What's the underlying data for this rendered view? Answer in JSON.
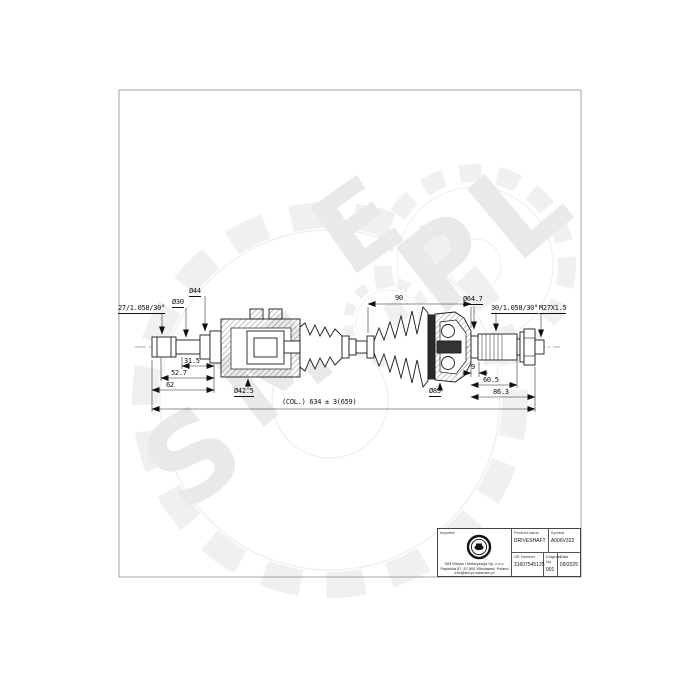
{
  "watermark": {
    "letters": [
      "S",
      "M",
      "E",
      "P",
      "L"
    ]
  },
  "drawing": {
    "labels": {
      "left_spline": "27/1.058/30°",
      "d30": "Ø30",
      "d44": "Ø44",
      "dim_31_5": "31.5",
      "dim_52_7": "52.7",
      "dim_62": "62",
      "d42_5": "Ø42.5",
      "overall": "(COL.) 634 ± 3(659)",
      "dim_90": "90",
      "d85": "Ø85",
      "d64_7": "Ø64.7",
      "right_spline": "30/1.058/30°",
      "thread": "M27X1.5",
      "dim_9": "9",
      "dim_60_5": "60.5",
      "dim_86_3": "86.3"
    }
  },
  "title_block": {
    "importer_label": "Importer",
    "importer_lines": [
      "SIM Wtrysk i Motoryzacja Sp. z o.o.",
      "Papieżka 87, 87-800 Włocławek, Poland",
      "info@sim.pl  www.sim.pl"
    ],
    "product_name_label": "Product name",
    "product_name": "DRIVESHAFT",
    "symbol_label": "Symbol",
    "symbol": "A006V322",
    "oe_label": "OE Number",
    "oe_number": "31607545125",
    "diagram_label": "Diagram No",
    "diagram_no": "001",
    "date_label": "Date",
    "date": "09/2025"
  }
}
